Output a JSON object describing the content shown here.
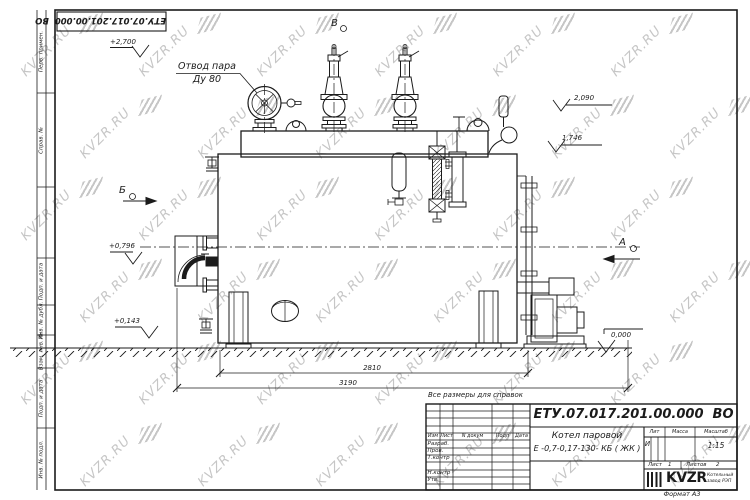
{
  "sheet": {
    "doc_number": "ЕТУ.07.017.201.00.000  ВО",
    "reference_note": "Все размеры для справок",
    "format_note": "Формат А3"
  },
  "margin": [
    "Перв. примен.",
    "Справ. №",
    "Подп. и дата",
    "Инв. № дубл.",
    "Взам. инв. №",
    "Подп. и дата",
    "Инв. № подл."
  ],
  "title_block": {
    "cols": [
      "Изм",
      "Лист",
      "N докум",
      "Подп",
      "Дата"
    ],
    "roles": [
      "Разраб.",
      "Пров.",
      "Т.контр",
      "Н.контр",
      "Утв."
    ],
    "product_line1": "Котел паровой",
    "product_line2": "Е -0,7-0,17-130- КБ ( ЖК )",
    "lit_label": "Лит",
    "mass_label": "Масса",
    "scale_label": "Масштаб",
    "lit_value": "И",
    "scale_value": "1:15",
    "sheet_label": "Лист",
    "sheet_value": "1",
    "sheets_label": "Листов",
    "sheets_value": "2",
    "logo_text": "KVZR",
    "logo_sub1": "Котельный",
    "logo_sub2": "завод РЭП"
  },
  "annotations": {
    "steam_outlet_line1": "Отвод пара",
    "steam_outlet_line2": "Ду 80",
    "elev_plus2700": "+2,700",
    "elev_2090": "2,090",
    "elev_1746": "1,746",
    "elev_plus0796": "+0,796",
    "elev_plus0143": "+0,143",
    "elev_0000": "0,000",
    "dim_2810": "2810",
    "dim_3190": "3190",
    "view_v": "В",
    "view_b": "Б",
    "view_a": "А"
  },
  "watermark": {
    "text": "KVZR.RU",
    "color": "#c6c6c6"
  }
}
